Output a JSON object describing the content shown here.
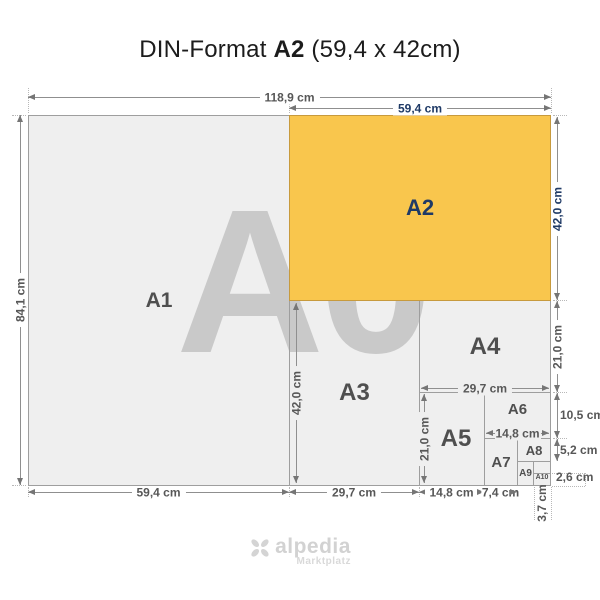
{
  "title": {
    "prefix": "DIN-Format",
    "format": "A2",
    "suffix": "(59,4 x 42cm)"
  },
  "watermark": "A0",
  "papers": {
    "a1": "A1",
    "a2": "A2",
    "a3": "A3",
    "a4": "A4",
    "a5": "A5",
    "a6": "A6",
    "a7": "A7",
    "a8": "A8",
    "a9": "A9",
    "a10": "A10"
  },
  "dimensions": {
    "total_width": "118,9 cm",
    "a2_width": "59,4 cm",
    "total_height": "84,1 cm",
    "a2_height": "42,0 cm",
    "a4_height": "21,0 cm",
    "a6_height": "10,5 cm",
    "a8_height": "5,2 cm",
    "a10_height": "2,6 cm",
    "a3_height": "42,0 cm",
    "a4_width": "29,7 cm",
    "a5_height": "21,0 cm",
    "a6_width": "14,8 cm",
    "a1_width": "59,4 cm",
    "a3_width": "29,7 cm",
    "a5_width": "14,8 cm",
    "a7_width": "7,4 cm",
    "a10_width": "3,7 cm"
  },
  "logo": {
    "name": "alpedia",
    "tagline": "Marktplatz"
  },
  "colors": {
    "highlight": "#F9C64D",
    "highlight_text": "#1F3A66",
    "paper_fill": "#EFEFEF",
    "watermark": "#C9C9C9"
  }
}
